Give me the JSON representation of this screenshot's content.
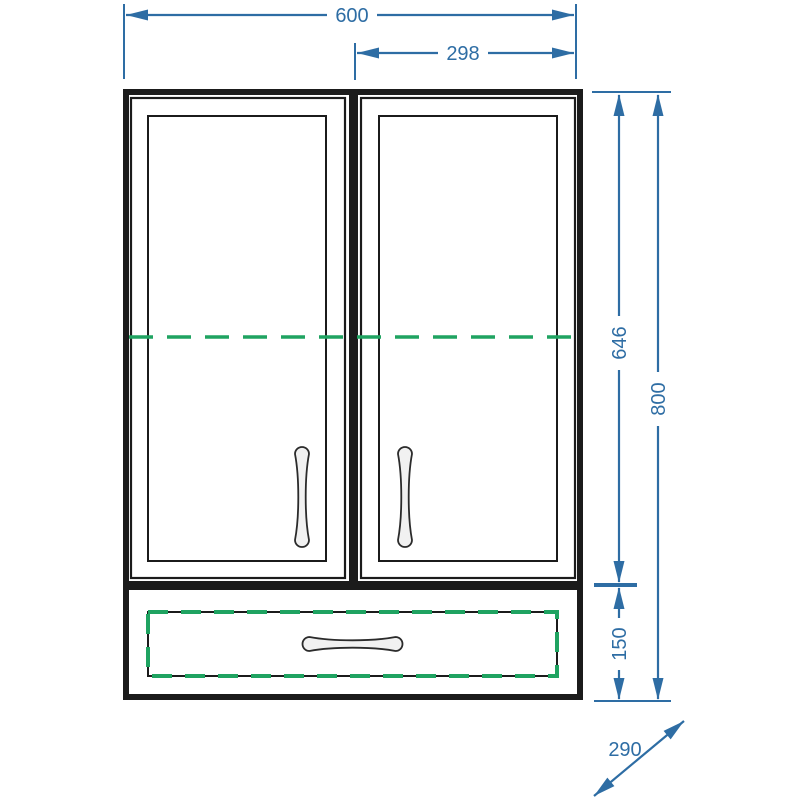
{
  "drawing": {
    "type": "cabinet-front-elevation-technical-drawing",
    "labels": {
      "overall_width": "600",
      "door_width": "298",
      "door_height": "646",
      "overall_height": "800",
      "drawer_height": "150",
      "depth": "290"
    },
    "colors": {
      "dimension_line": "#2e6da4",
      "dashed_highlight": "#1fa361",
      "outline": "#1b1b1b",
      "handle_fill": "#f1f1f1",
      "background": "#ffffff"
    }
  }
}
